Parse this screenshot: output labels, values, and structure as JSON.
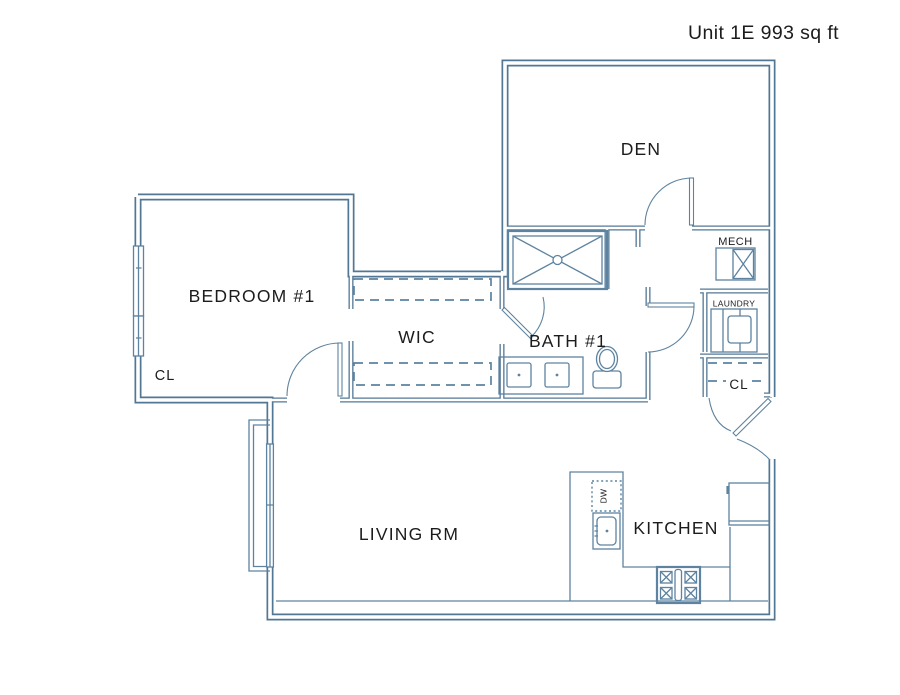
{
  "title": "Unit 1E 993 sq ft",
  "rooms": {
    "den": "DEN",
    "bedroom1": "BEDROOM #1",
    "bedroom_closet": "CL",
    "wic": "WIC",
    "bath1": "BATH #1",
    "mech": "MECH",
    "laundry": "LAUNDRY",
    "entry_closet": "CL",
    "living": "LIVING RM",
    "kitchen": "KITCHEN",
    "dishwasher": "DW"
  },
  "colors": {
    "wall": "#527795",
    "fixture": "#5d83a0",
    "text": "#1c1c1c",
    "background": "#ffffff"
  }
}
